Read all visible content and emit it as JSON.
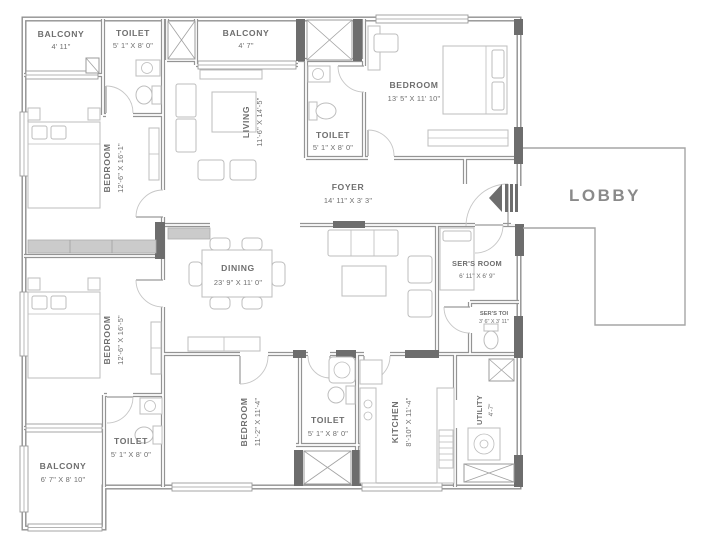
{
  "rooms": {
    "balcony_top_left": {
      "name": "BALCONY",
      "dim": "4' 11\""
    },
    "toilet_top_left": {
      "name": "TOILET",
      "dim": "5' 1\" X 8' 0\""
    },
    "balcony_top_center": {
      "name": "BALCONY",
      "dim": "4' 7\""
    },
    "bedroom_top_right": {
      "name": "BEDROOM",
      "dim": "13' 5\" X 11' 10\""
    },
    "living": {
      "name": "LIVING",
      "dim": "11'-6\" X 14'-5\""
    },
    "toilet_center": {
      "name": "TOILET",
      "dim": "5' 1\" X 8' 0\""
    },
    "foyer": {
      "name": "FOYER",
      "dim": "14' 11\" X 3' 3\""
    },
    "lobby": {
      "name": "LOBBY"
    },
    "bedroom_left_upper": {
      "name": "BEDROOM",
      "dim": "12'-6\" X 16'-1\""
    },
    "dining": {
      "name": "DINING",
      "dim": "23' 9\" X 11' 0\""
    },
    "servants_room": {
      "name": "SER'S ROOM",
      "dim": "6' 11\" X 6' 9\""
    },
    "servants_toilet": {
      "name": "SER'S TOI",
      "dim": "3' 6\" X 3' 11\""
    },
    "bedroom_left_lower": {
      "name": "BEDROOM",
      "dim": "12'-6\" X 16'-5\""
    },
    "bedroom_bottom": {
      "name": "BEDROOM",
      "dim": "11'-2\" X 11'-4\""
    },
    "toilet_bottom": {
      "name": "TOILET",
      "dim": "5' 1\" X 8' 0\""
    },
    "kitchen": {
      "name": "KITCHEN",
      "dim": "8'-10\" X 11'-4\""
    },
    "utility": {
      "name": "UTILITY",
      "dim": "4'-7\""
    },
    "toilet_bottom_left": {
      "name": "TOILET",
      "dim": "5' 1\" X 8' 0\""
    },
    "balcony_bottom_left": {
      "name": "BALCONY",
      "dim": "6' 7\" X 8' 10\""
    }
  },
  "colors": {
    "wall": "#8f8f8f",
    "dark_wall": "#6d6d6d",
    "furniture": "#bdbdbd",
    "label_text": "#6e6e6e",
    "lobby_text": "#8a8a8a",
    "background": "#ffffff"
  }
}
